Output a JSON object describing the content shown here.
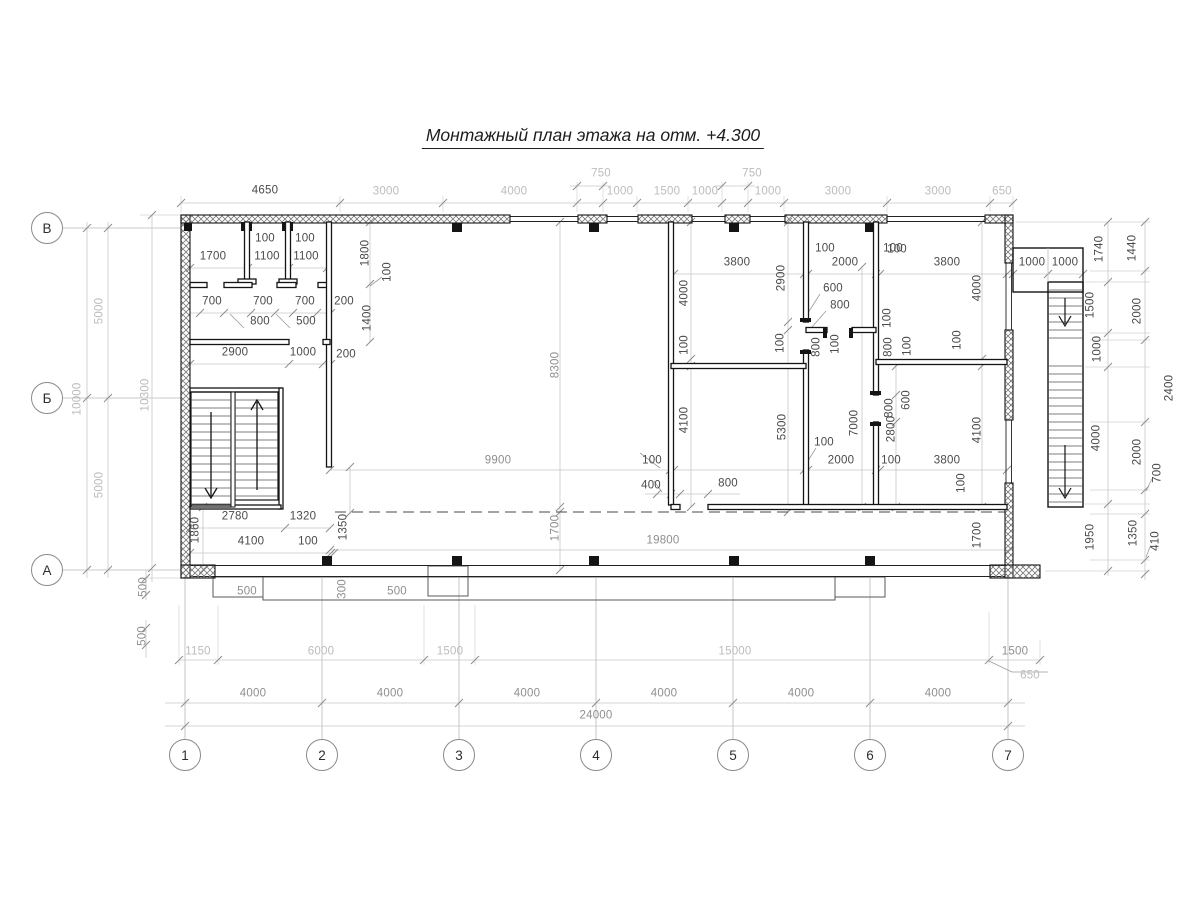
{
  "title": "Монтажный план этажа на отм. +4.300",
  "axes": {
    "rows": [
      {
        "label": "В",
        "x": 47,
        "y": 228
      },
      {
        "label": "Б",
        "x": 47,
        "y": 398
      },
      {
        "label": "А",
        "x": 47,
        "y": 570
      }
    ],
    "cols": [
      {
        "label": "1",
        "x": 185,
        "y": 755
      },
      {
        "label": "2",
        "x": 322,
        "y": 755
      },
      {
        "label": "3",
        "x": 459,
        "y": 755
      },
      {
        "label": "4",
        "x": 596,
        "y": 755
      },
      {
        "label": "5",
        "x": 733,
        "y": 755
      },
      {
        "label": "6",
        "x": 870,
        "y": 755
      },
      {
        "label": "7",
        "x": 1008,
        "y": 755
      }
    ]
  },
  "colors": {
    "wall": "#141414",
    "dim_line": "#c8c8c8",
    "dim_text_light": "#bcbcbc",
    "dim_text_dark": "#4a4a4a"
  },
  "dims": [
    [
      "4650",
      265,
      191,
      0,
      "dk"
    ],
    [
      "3000",
      386,
      192,
      0,
      "lt"
    ],
    [
      "4000",
      514,
      192,
      0,
      "lt"
    ],
    [
      "750",
      601,
      174,
      0,
      "lt"
    ],
    [
      "1000",
      620,
      192,
      0,
      "lt"
    ],
    [
      "1500",
      667,
      192,
      0,
      "lt"
    ],
    [
      "1000",
      705,
      192,
      0,
      "lt"
    ],
    [
      "750",
      752,
      174,
      0,
      "lt"
    ],
    [
      "1000",
      768,
      192,
      0,
      "lt"
    ],
    [
      "3000",
      838,
      192,
      0,
      "lt"
    ],
    [
      "3000",
      938,
      192,
      0,
      "lt"
    ],
    [
      "650",
      1002,
      192,
      0,
      "lt"
    ],
    [
      "5000",
      100,
      311,
      1,
      "lt"
    ],
    [
      "10000",
      78,
      399,
      1,
      "lt"
    ],
    [
      "5000",
      100,
      485,
      1,
      "lt"
    ],
    [
      "10300",
      146,
      395,
      1,
      "lt"
    ],
    [
      "500",
      144,
      587,
      1,
      "md"
    ],
    [
      "500",
      143,
      636,
      1,
      "md"
    ],
    [
      "1740",
      1100,
      249,
      1,
      "dk"
    ],
    [
      "1500",
      1091,
      305,
      1,
      "dk"
    ],
    [
      "1000",
      1098,
      349,
      1,
      "dk"
    ],
    [
      "4000",
      1097,
      438,
      1,
      "dk"
    ],
    [
      "1950",
      1091,
      537,
      1,
      "dk"
    ],
    [
      "1440",
      1133,
      248,
      1,
      "dk"
    ],
    [
      "2000",
      1138,
      311,
      1,
      "dk"
    ],
    [
      "2400",
      1170,
      388,
      1,
      "dk"
    ],
    [
      "2000",
      1138,
      452,
      1,
      "dk"
    ],
    [
      "700",
      1158,
      473,
      1,
      "dk"
    ],
    [
      "1350",
      1134,
      533,
      1,
      "dk"
    ],
    [
      "410",
      1156,
      541,
      1,
      "dk"
    ],
    [
      "500",
      247,
      592,
      0,
      "md"
    ],
    [
      "300",
      343,
      589,
      1,
      "md"
    ],
    [
      "500",
      397,
      592,
      0,
      "md"
    ],
    [
      "1150",
      198,
      652,
      0,
      "lt"
    ],
    [
      "6000",
      321,
      652,
      0,
      "lt"
    ],
    [
      "1500",
      450,
      652,
      0,
      "lt"
    ],
    [
      "15000",
      735,
      652,
      0,
      "lt"
    ],
    [
      "1500",
      1015,
      652,
      0,
      "md"
    ],
    [
      "650",
      1030,
      676,
      0,
      "lt"
    ],
    [
      "4000",
      253,
      694,
      0,
      "md"
    ],
    [
      "4000",
      390,
      694,
      0,
      "md"
    ],
    [
      "4000",
      527,
      694,
      0,
      "md"
    ],
    [
      "4000",
      664,
      694,
      0,
      "md"
    ],
    [
      "4000",
      801,
      694,
      0,
      "md"
    ],
    [
      "4000",
      938,
      694,
      0,
      "md"
    ],
    [
      "24000",
      596,
      716,
      0,
      "md"
    ],
    [
      "1700",
      213,
      257,
      0,
      "dk"
    ],
    [
      "100",
      265,
      239,
      0,
      "dk"
    ],
    [
      "1100",
      267,
      257,
      0,
      "dk"
    ],
    [
      "100",
      305,
      239,
      0,
      "dk"
    ],
    [
      "1100",
      306,
      257,
      0,
      "dk"
    ],
    [
      "1800",
      366,
      253,
      1,
      "dk"
    ],
    [
      "100",
      388,
      272,
      1,
      "dk"
    ],
    [
      "700",
      212,
      302,
      0,
      "dk"
    ],
    [
      "700",
      263,
      302,
      0,
      "dk"
    ],
    [
      "700",
      305,
      302,
      0,
      "dk"
    ],
    [
      "200",
      344,
      302,
      0,
      "dk"
    ],
    [
      "800",
      260,
      322,
      0,
      "dk"
    ],
    [
      "500",
      306,
      322,
      0,
      "dk"
    ],
    [
      "1400",
      368,
      318,
      1,
      "dk"
    ],
    [
      "2900",
      235,
      353,
      0,
      "dk"
    ],
    [
      "1000",
      303,
      353,
      0,
      "dk"
    ],
    [
      "200",
      346,
      355,
      0,
      "dk"
    ],
    [
      "2780",
      235,
      517,
      0,
      "dk"
    ],
    [
      "1320",
      303,
      517,
      0,
      "dk"
    ],
    [
      "4100",
      251,
      542,
      0,
      "dk"
    ],
    [
      "100",
      308,
      542,
      0,
      "dk"
    ],
    [
      "1860",
      196,
      530,
      1,
      "dk"
    ],
    [
      "1350",
      344,
      527,
      1,
      "dk"
    ],
    [
      "8300",
      556,
      365,
      1,
      "md"
    ],
    [
      "9900",
      498,
      461,
      0,
      "md"
    ],
    [
      "100",
      652,
      461,
      0,
      "dk"
    ],
    [
      "400",
      651,
      486,
      0,
      "dk"
    ],
    [
      "1700",
      556,
      528,
      1,
      "md"
    ],
    [
      "19800",
      663,
      541,
      0,
      "md"
    ],
    [
      "800",
      728,
      484,
      0,
      "dk"
    ],
    [
      "3800",
      737,
      263,
      0,
      "dk"
    ],
    [
      "100",
      825,
      249,
      0,
      "dk"
    ],
    [
      "2000",
      845,
      263,
      0,
      "dk"
    ],
    [
      "100",
      893,
      249,
      0,
      "dk"
    ],
    [
      "2900",
      782,
      278,
      1,
      "dk"
    ],
    [
      "4000",
      685,
      293,
      1,
      "dk"
    ],
    [
      "100",
      685,
      345,
      1,
      "dk"
    ],
    [
      "4100",
      685,
      420,
      1,
      "dk"
    ],
    [
      "600",
      833,
      289,
      0,
      "dk"
    ],
    [
      "800",
      840,
      306,
      0,
      "dk"
    ],
    [
      "100",
      781,
      343,
      1,
      "dk"
    ],
    [
      "800",
      817,
      347,
      1,
      "dk"
    ],
    [
      "100",
      836,
      344,
      1,
      "dk"
    ],
    [
      "100",
      888,
      318,
      1,
      "dk"
    ],
    [
      "800",
      889,
      347,
      1,
      "dk"
    ],
    [
      "100",
      908,
      346,
      1,
      "dk"
    ],
    [
      "600",
      907,
      400,
      1,
      "dk"
    ],
    [
      "800",
      890,
      408,
      1,
      "dk"
    ],
    [
      "2800",
      892,
      429,
      1,
      "dk"
    ],
    [
      "7000",
      855,
      423,
      1,
      "dk"
    ],
    [
      "5300",
      783,
      427,
      1,
      "dk"
    ],
    [
      "100",
      824,
      443,
      0,
      "dk"
    ],
    [
      "2000",
      841,
      461,
      0,
      "dk"
    ],
    [
      "100",
      891,
      461,
      0,
      "dk"
    ],
    [
      "100",
      897,
      250,
      0,
      "dk"
    ],
    [
      "3800",
      947,
      263,
      0,
      "dk"
    ],
    [
      "1000",
      1032,
      263,
      0,
      "dk"
    ],
    [
      "1000",
      1065,
      263,
      0,
      "dk"
    ],
    [
      "4000",
      978,
      288,
      1,
      "dk"
    ],
    [
      "100",
      958,
      340,
      1,
      "dk"
    ],
    [
      "3800",
      947,
      461,
      0,
      "dk"
    ],
    [
      "100",
      962,
      483,
      1,
      "dk"
    ],
    [
      "4100",
      978,
      430,
      1,
      "dk"
    ],
    [
      "1700",
      978,
      535,
      1,
      "dk"
    ]
  ]
}
